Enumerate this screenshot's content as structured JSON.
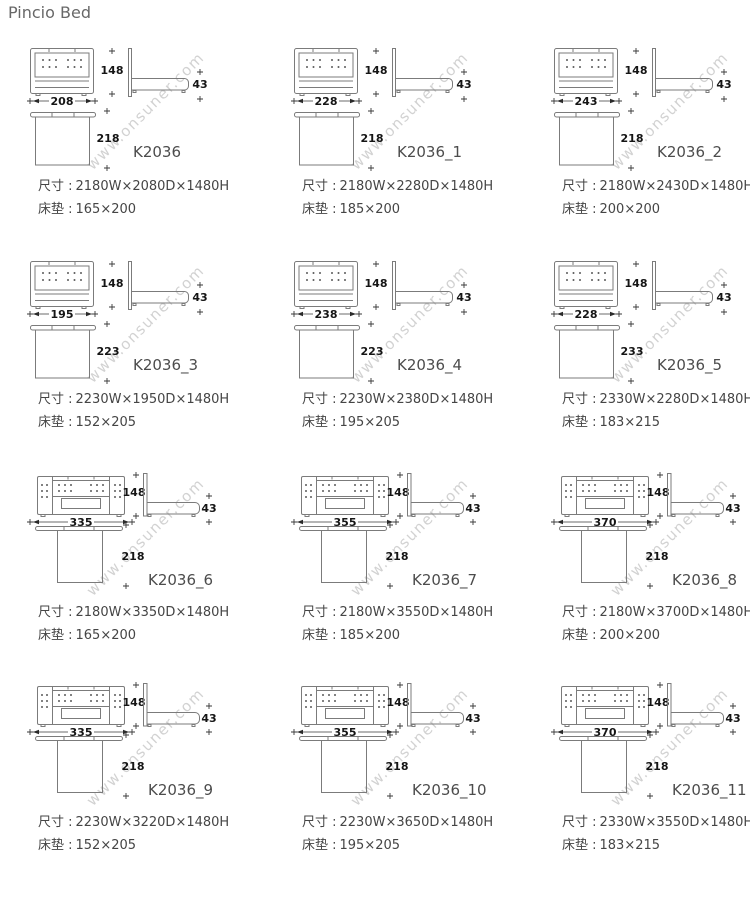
{
  "page": {
    "title": "Pincio Bed",
    "watermark": "www.onsuner.com"
  },
  "labels": {
    "size": "尺寸 :",
    "mattress": "床垫 :"
  },
  "cells": [
    {
      "model": "K2036",
      "type": "A",
      "width_label": "208",
      "height_label": "148",
      "side_label": "43",
      "depth_label": "218",
      "dims": "2180W×2080D×1480H",
      "mattress": "165×200"
    },
    {
      "model": "K2036_1",
      "type": "A",
      "width_label": "228",
      "height_label": "148",
      "side_label": "43",
      "depth_label": "218",
      "dims": "2180W×2280D×1480H",
      "mattress": "185×200"
    },
    {
      "model": "K2036_2",
      "type": "A",
      "width_label": "243",
      "height_label": "148",
      "side_label": "43",
      "depth_label": "218",
      "dims": "2180W×2430D×1480H",
      "mattress": "200×200"
    },
    {
      "model": "K2036_3",
      "type": "A",
      "width_label": "195",
      "height_label": "148",
      "side_label": "43",
      "depth_label": "223",
      "dims": "2230W×1950D×1480H",
      "mattress": "152×205"
    },
    {
      "model": "K2036_4",
      "type": "A",
      "width_label": "238",
      "height_label": "148",
      "side_label": "43",
      "depth_label": "223",
      "dims": "2230W×2380D×1480H",
      "mattress": "195×205"
    },
    {
      "model": "K2036_5",
      "type": "A",
      "width_label": "228",
      "height_label": "148",
      "side_label": "43",
      "depth_label": "233",
      "dims": "2330W×2280D×1480H",
      "mattress": "183×215"
    },
    {
      "model": "K2036_6",
      "type": "B",
      "width_label": "335",
      "height_label": "148",
      "side_label": "43",
      "depth_label": "218",
      "dims": "2180W×3350D×1480H",
      "mattress": "165×200"
    },
    {
      "model": "K2036_7",
      "type": "B",
      "width_label": "355",
      "height_label": "148",
      "side_label": "43",
      "depth_label": "218",
      "dims": "2180W×3550D×1480H",
      "mattress": "185×200"
    },
    {
      "model": "K2036_8",
      "type": "B",
      "width_label": "370",
      "height_label": "148",
      "side_label": "43",
      "depth_label": "218",
      "dims": "2180W×3700D×1480H",
      "mattress": "200×200"
    },
    {
      "model": "K2036_9",
      "type": "B",
      "width_label": "335",
      "height_label": "148",
      "side_label": "43",
      "depth_label": "218",
      "dims": "2230W×3220D×1480H",
      "mattress": "152×205"
    },
    {
      "model": "K2036_10",
      "type": "B",
      "width_label": "355",
      "height_label": "148",
      "side_label": "43",
      "depth_label": "218",
      "dims": "2230W×3650D×1480H",
      "mattress": "195×205"
    },
    {
      "model": "K2036_11",
      "type": "B",
      "width_label": "370",
      "height_label": "148",
      "side_label": "43",
      "depth_label": "218",
      "dims": "2330W×3550D×1480H",
      "mattress": "183×215"
    }
  ],
  "layout": {
    "cols": [
      28,
      292,
      552
    ],
    "rows": [
      42,
      255,
      468,
      678
    ]
  }
}
